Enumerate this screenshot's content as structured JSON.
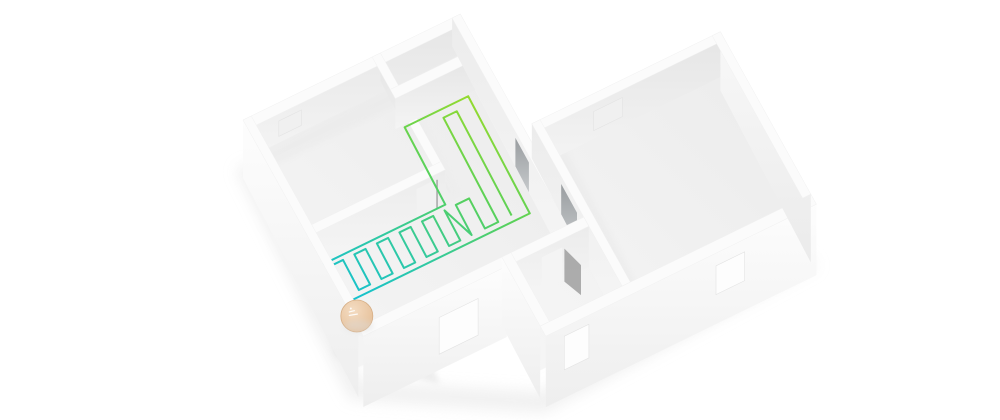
{
  "scene": {
    "label": "isometric-floorplan-underfloor-heating",
    "rooms": [
      "top-left-room",
      "hallway-l-shaped-heated-room",
      "small-top-closet",
      "bottom-middle-room",
      "large-right-room"
    ],
    "heated_area_shape": "L"
  },
  "colors": {
    "background": "#ffffff",
    "wall_top": "#fbfbfb",
    "wall_top_edge": "#f1f1f1",
    "face_shaded_top": "#e6e6e6",
    "face_shaded_bottom": "#f4f4f4",
    "face_mid_top": "#ececec",
    "face_mid_bottom": "#f6f6f6",
    "exterior_top": "#fdfdfd",
    "exterior_bottom": "#eeeeee",
    "exterior_right_top": "#f8f8f8",
    "exterior_right_bottom": "#ebebeb",
    "floor_near": "#f6f6f6",
    "floor_far": "#ebebeb",
    "floor_ao": "#e7e7e7",
    "window_hole_back": "#f0f0f0",
    "window_hole_front": "#fdfdfd",
    "doorway_dark_top": "#999da0",
    "doorway_dark_bottom": "#c6c9cb",
    "door_leaf": "#9a9a9a",
    "shadow": "#e5e5e5",
    "shadow_dark": "#dcdcdc",
    "pipe_gradient": [
      "#10bfd8",
      "#2fc9a4",
      "#5ad159",
      "#93da30"
    ],
    "puck_center": "#f4dcc2",
    "puck_mid": "#e9c6a2",
    "puck_edge": "#e0ba94",
    "puck_border": "#d6ae85",
    "puck_marks": "#ffffff"
  },
  "heating_loop": {
    "bottom_arm_teeth": 10,
    "hall_runs": 4,
    "start_device": "manifold-puck"
  },
  "puck": {
    "shape": "circle"
  }
}
